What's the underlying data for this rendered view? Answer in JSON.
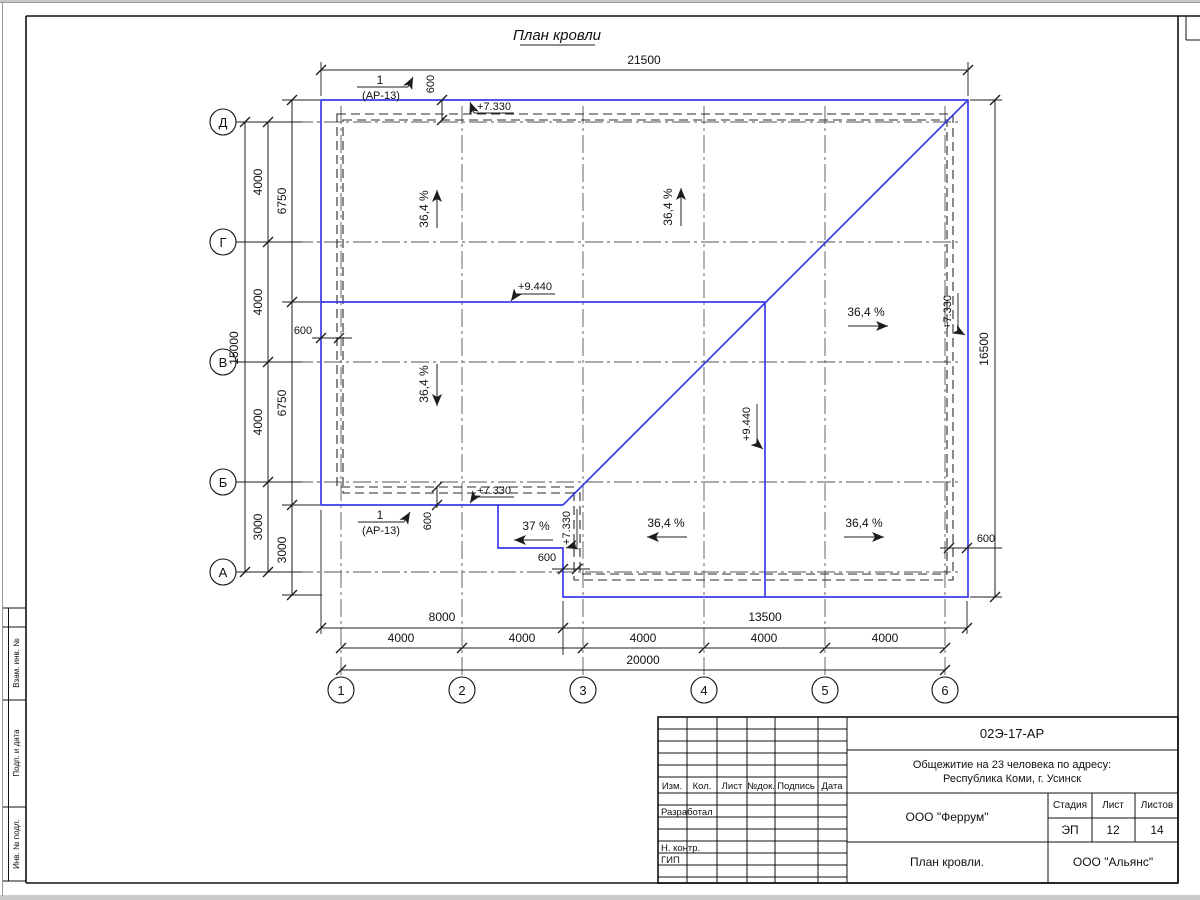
{
  "page": {
    "title": "План кровли"
  },
  "dims": {
    "top_total": "21500",
    "left_total": "15000",
    "right_total": "16500",
    "bottom_total": "20000",
    "bottom_left": "8000",
    "bottom_right": "13500",
    "left_chain": [
      "4000",
      "4000",
      "4000",
      "3000"
    ],
    "left_eaves_chain": [
      "6750",
      "6750",
      "3000"
    ],
    "bottom_chain": [
      "4000",
      "4000",
      "4000",
      "4000",
      "4000"
    ],
    "overhang": "600"
  },
  "axes": {
    "rows": [
      "Д",
      "Г",
      "В",
      "Б",
      "А"
    ],
    "cols": [
      "1",
      "2",
      "3",
      "4",
      "5",
      "6"
    ]
  },
  "slopes": {
    "main": "36,4 %",
    "porch": "37 %"
  },
  "elevations": {
    "eave": "+7.330",
    "ridge": "+9.440"
  },
  "callout": {
    "number": "1",
    "sheet_ref": "(АР-13)"
  },
  "strip": {
    "cells": [
      "Взам. инв. №",
      "Подп. и дата",
      "Инв. № подл."
    ]
  },
  "titleblock": {
    "doc_number": "02Э-17-АР",
    "project_line1": "Общежитие на 23 человека по адресу:",
    "project_line2": "Республика Коми, г. Усинск",
    "contractor": "ООО \"Феррум\"",
    "stage_label": "Стадия",
    "sheet_label": "Лист",
    "sheets_label": "Листов",
    "stage": "ЭП",
    "sheet": "12",
    "sheets": "14",
    "drawing_title": "План кровли.",
    "company": "ООО \"Альянс\"",
    "columns": [
      "Изм.",
      "Кол.",
      "Лист",
      "№док.",
      "Подпись",
      "Дата"
    ],
    "roles": [
      "Разработал",
      "Н. контр.",
      "ГИП"
    ]
  },
  "colors": {
    "roof_line": "#3b3beb"
  }
}
